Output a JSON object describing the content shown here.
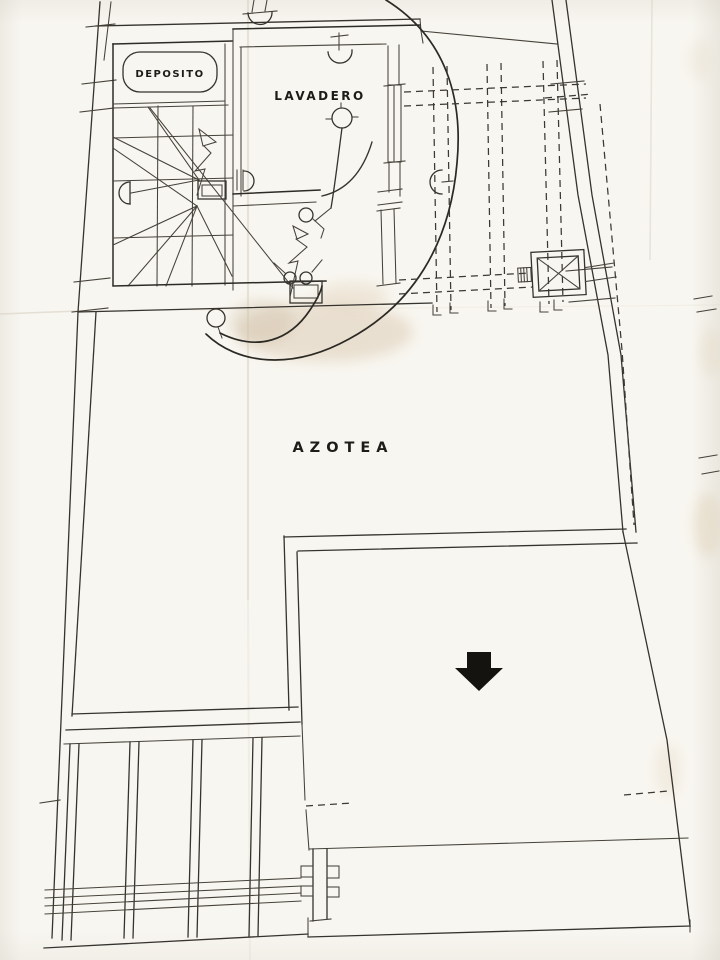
{
  "plan": {
    "rooms": [
      {
        "label": "DEPOSITO"
      },
      {
        "label": "LAVADERO"
      }
    ],
    "area_label": "AZOTEA",
    "symbols": [
      "down-arrow-icon",
      "stair-direction-arrow-icon",
      "ceiling-lamp-icon",
      "wall-lamp-icon",
      "drain-circle-icon",
      "water-tank-icon",
      "door-swing-arc"
    ],
    "colors": {
      "paper": "#f8f6f0",
      "ink": "#32302a",
      "crease": "#d9d2c4",
      "smudge": "#d8c5ab"
    }
  }
}
